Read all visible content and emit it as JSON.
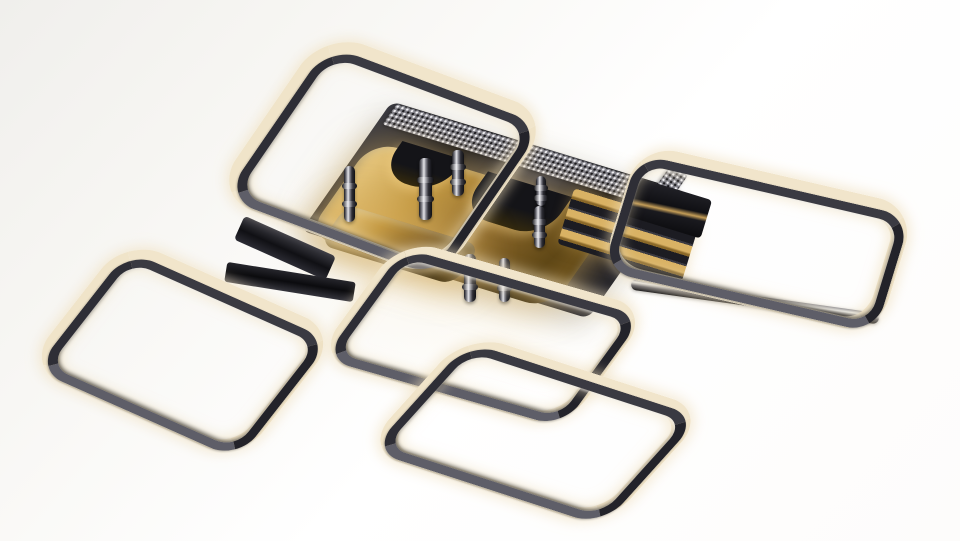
{
  "meta": {
    "type": "product-photo",
    "subject": "modern-led-square-ring-ceiling-chandelier",
    "finish": "polished black chrome with warm-white acrylic diffusers and brass backplates",
    "visible_text": ""
  },
  "scene": {
    "stage": {
      "width": 960,
      "height": 541
    },
    "palette": {
      "diffuser_cream": "#f1e5cb",
      "diffuser_glow": "#eeddb9",
      "chrome_dark": "#26262d",
      "chrome_mid": "#55555e",
      "chrome_light": "#eceef0",
      "gold_light": "#eccd86",
      "gold_mid": "#c49a44",
      "gold_dark": "#5f4716",
      "mesh_base": "#7d7d86",
      "warm_glow": "rgba(246,236,212,0.45)",
      "background": "#ffffff"
    },
    "canopy": {
      "name": "mounting-plate",
      "x": 340,
      "y": 135,
      "w": 300,
      "h": 150,
      "rot": 17,
      "skew": -18
    },
    "mesh_bands": [
      {
        "name": "mesh-trim-top",
        "x": 383,
        "y": 146,
        "w": 300,
        "h": 24,
        "rot": 17,
        "skew": -18
      },
      {
        "name": "mesh-trim-right",
        "x": 612,
        "y": 195,
        "w": 86,
        "h": 20,
        "rot": 125,
        "skew": 0
      }
    ],
    "gold_plates": [
      {
        "name": "gold-backplate-main",
        "x": 334,
        "y": 170,
        "w": 255,
        "h": 110,
        "rot": 17,
        "skew": -18,
        "radius": 26,
        "arches": [
          {
            "x": 26,
            "y": -8,
            "w": 64,
            "h": 40
          },
          {
            "x": 118,
            "y": -4,
            "w": 88,
            "h": 48
          },
          {
            "x": 224,
            "y": -6,
            "w": 46,
            "h": 30
          }
        ]
      },
      {
        "name": "gold-backplate-small",
        "x": 330,
        "y": 222,
        "w": 140,
        "h": 46,
        "rot": 17,
        "skew": -18,
        "radius": 14,
        "arches": []
      }
    ],
    "bars": [
      {
        "name": "connector-arm-left",
        "type": "dark-bar",
        "x": 235,
        "y": 235,
        "w": 100,
        "h": 26,
        "rot": 24
      },
      {
        "name": "connector-arm-left-lower",
        "type": "dark-bar2",
        "x": 225,
        "y": 272,
        "w": 130,
        "h": 20,
        "rot": 9
      },
      {
        "name": "gold-strip-stack",
        "type": "gold-strips",
        "x": 563,
        "y": 206,
        "w": 130,
        "h": 58,
        "rot": 17
      },
      {
        "name": "connector-block-right",
        "type": "dark-block",
        "x": 630,
        "y": 188,
        "w": 78,
        "h": 40,
        "rot": 17
      },
      {
        "name": "connector-arm-long",
        "type": "chrome-bar",
        "x": 630,
        "y": 296,
        "w": 250,
        "h": 11,
        "rot": 8
      }
    ],
    "rods": [
      {
        "name": "support-rod",
        "x": 344,
        "y": 166,
        "w": 11,
        "h": 56
      },
      {
        "name": "support-rod",
        "x": 419,
        "y": 158,
        "w": 13,
        "h": 62
      },
      {
        "name": "support-rod",
        "x": 452,
        "y": 150,
        "w": 12,
        "h": 46
      },
      {
        "name": "support-rod",
        "x": 536,
        "y": 176,
        "w": 10,
        "h": 30
      },
      {
        "name": "support-rod",
        "x": 534,
        "y": 206,
        "w": 11,
        "h": 42
      },
      {
        "name": "support-rod",
        "x": 464,
        "y": 254,
        "w": 12,
        "h": 48
      },
      {
        "name": "support-rod",
        "x": 499,
        "y": 258,
        "w": 11,
        "h": 44
      }
    ],
    "rings": [
      {
        "name": "light-ring-top-left",
        "x": 260,
        "y": 58,
        "w": 245,
        "h": 195,
        "rot": 20.5,
        "skew": -14,
        "diffuser_border": "22px 14px 13px 20px",
        "chrome_inset": "13px 3px 2px 12px",
        "outer_radius": 44,
        "chrome_radius": 34
      },
      {
        "name": "light-ring-top-right",
        "x": 616,
        "y": 172,
        "w": 285,
        "h": 135,
        "rot": 13,
        "skew": -4,
        "diffuser_border": "20px 16px 12px 8px",
        "chrome_inset": "11px 3px 2px 2px",
        "outer_radius": 40,
        "chrome_radius": 30
      },
      {
        "name": "light-ring-left",
        "x": 65,
        "y": 270,
        "w": 235,
        "h": 160,
        "rot": 24,
        "skew": -14,
        "diffuser_border": "20px 14px 12px 18px",
        "chrome_inset": "11px 3px 2px 10px",
        "outer_radius": 40,
        "chrome_radius": 30
      },
      {
        "name": "light-ring-center",
        "x": 353,
        "y": 264,
        "w": 260,
        "h": 140,
        "rot": 16,
        "skew": -20,
        "diffuser_border": "18px 14px 12px 16px",
        "chrome_inset": "9px 3px 2px 8px",
        "outer_radius": 38,
        "chrome_radius": 28
      },
      {
        "name": "light-ring-bottom",
        "x": 408,
        "y": 358,
        "w": 255,
        "h": 145,
        "rot": 18,
        "skew": -24,
        "diffuser_border": "18px 15px 13px 16px",
        "chrome_inset": "9px 3px 2px 8px",
        "outer_radius": 40,
        "chrome_radius": 30
      }
    ]
  }
}
